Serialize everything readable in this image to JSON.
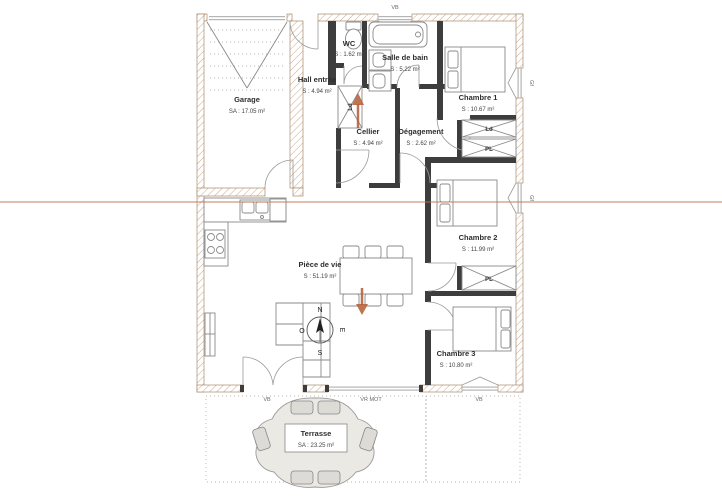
{
  "rooms": {
    "garage": {
      "name": "Garage",
      "area": "SA : 17.05 m²"
    },
    "wc": {
      "name": "WC",
      "area": "S : 1.62 m²"
    },
    "salle_de_bain": {
      "name": "Salle de bain",
      "area": "S : 5.22 m²"
    },
    "hall": {
      "name": "Hall entrée",
      "area": "S : 4.94 m²"
    },
    "chambre1": {
      "name": "Chambre 1",
      "area": "S : 10.67 m²"
    },
    "cellier": {
      "name": "Cellier",
      "area": "S : 4.94 m²"
    },
    "degagement": {
      "name": "Dégagement",
      "area": "S : 2.62 m²"
    },
    "chambre2": {
      "name": "Chambre 2",
      "area": "S : 11.99 m²"
    },
    "piece_de_vie": {
      "name": "Pièce de vie",
      "area": "S : 51.19 m²"
    },
    "chambre3": {
      "name": "Chambre 3",
      "area": "S : 10.80 m²"
    },
    "terrasse": {
      "name": "Terrasse",
      "area": "SA : 23.25 m²"
    }
  },
  "openings": {
    "vb_top": "VB",
    "gf_chambre1": "Gf",
    "gf_chambre2": "Gf",
    "vb_bottom_left": "VB",
    "vr_mot": "VR MOT",
    "vb_bottom_right": "VB"
  },
  "closets": {
    "ld_cellier": "Ld",
    "ld_hall": "Ld",
    "pl_hall": "PL",
    "pl_chambre2": "PL"
  },
  "compass": {
    "n": "N",
    "e": "E",
    "s": "S",
    "o": "O"
  },
  "colors": {
    "section_line": "#c0714f",
    "arrow": "#b35a33",
    "interior_wall": "#3d3d3d",
    "hatch": "#c8a98c",
    "terrace_fill": "#ebe9e4"
  }
}
